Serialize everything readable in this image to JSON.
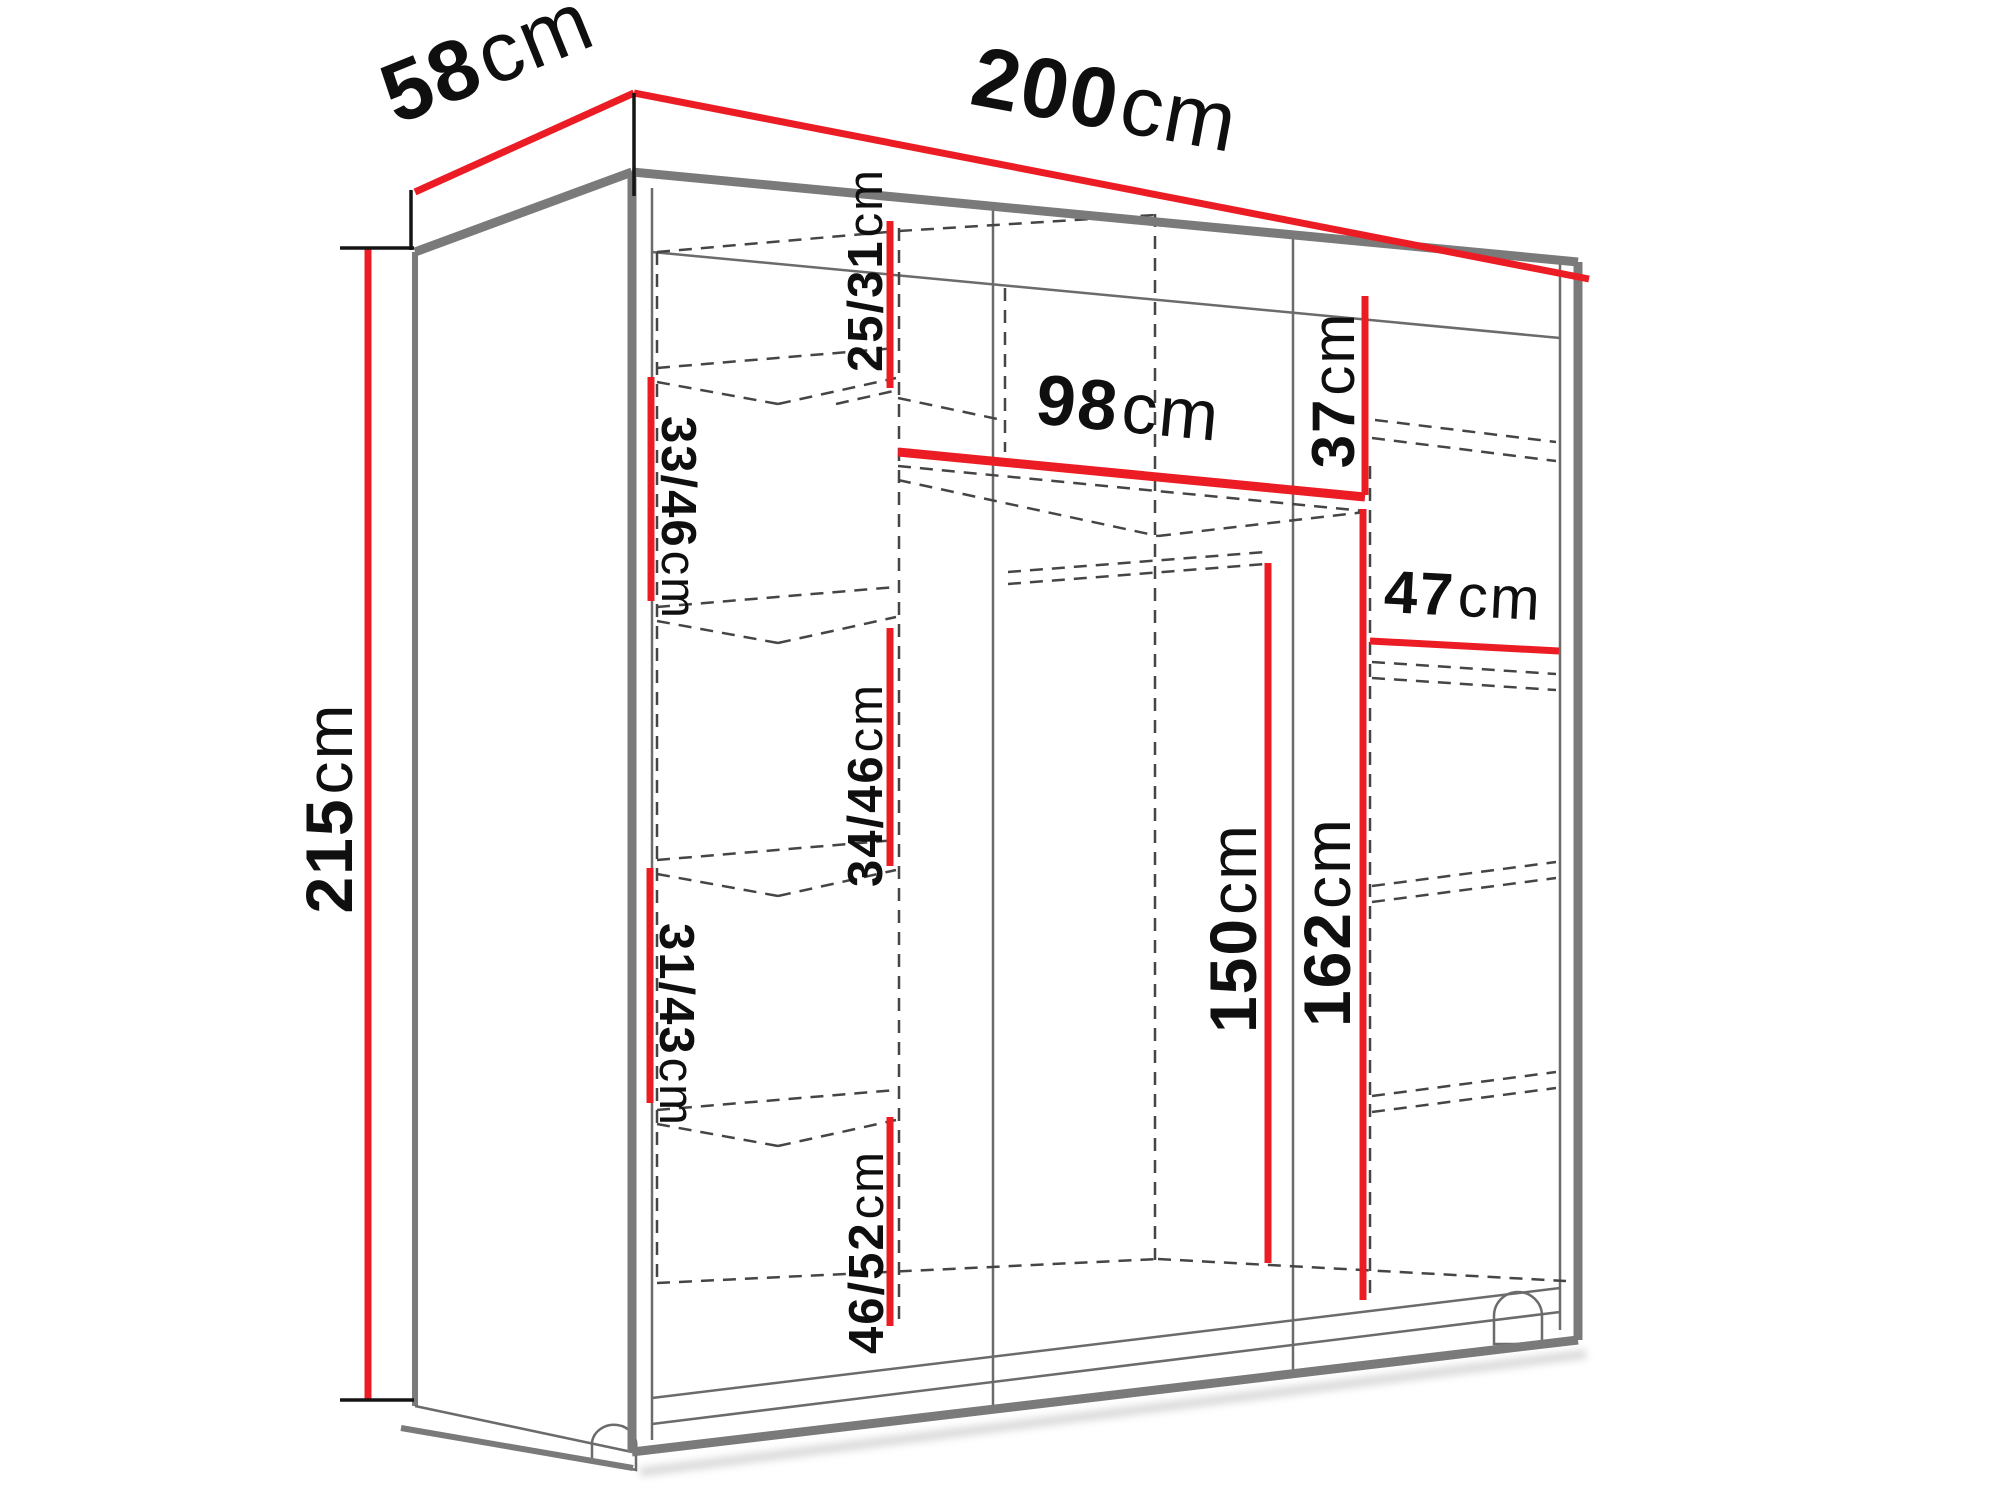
{
  "diagram": {
    "type": "wardrobe-dimension-diagram",
    "colors": {
      "dimension_line": "#ec1c24",
      "edge": "#7a7a7a",
      "text": "#0f0f0f",
      "background": "#ffffff"
    },
    "overall": {
      "width": {
        "value": "200",
        "unit": "cm"
      },
      "depth": {
        "value": "58",
        "unit": "cm"
      },
      "height": {
        "value": "215",
        "unit": "cm"
      }
    },
    "interior": {
      "top_left_compartment_height": {
        "value": "25/31",
        "unit": "cm"
      },
      "left_shelf_gap_1": {
        "value": "33/46",
        "unit": "cm"
      },
      "center_top_shelf_width": {
        "value": "98",
        "unit": "cm"
      },
      "top_right_compartment_height": {
        "value": "37",
        "unit": "cm"
      },
      "right_shelf_width": {
        "value": "47",
        "unit": "cm"
      },
      "left_shelf_gap_2": {
        "value": "34/46",
        "unit": "cm"
      },
      "hanging_space_height": {
        "value": "150",
        "unit": "cm"
      },
      "right_section_height": {
        "value": "162",
        "unit": "cm"
      },
      "left_shelf_gap_3": {
        "value": "31/43",
        "unit": "cm"
      },
      "left_shelf_gap_4": {
        "value": "46/52",
        "unit": "cm"
      }
    }
  }
}
